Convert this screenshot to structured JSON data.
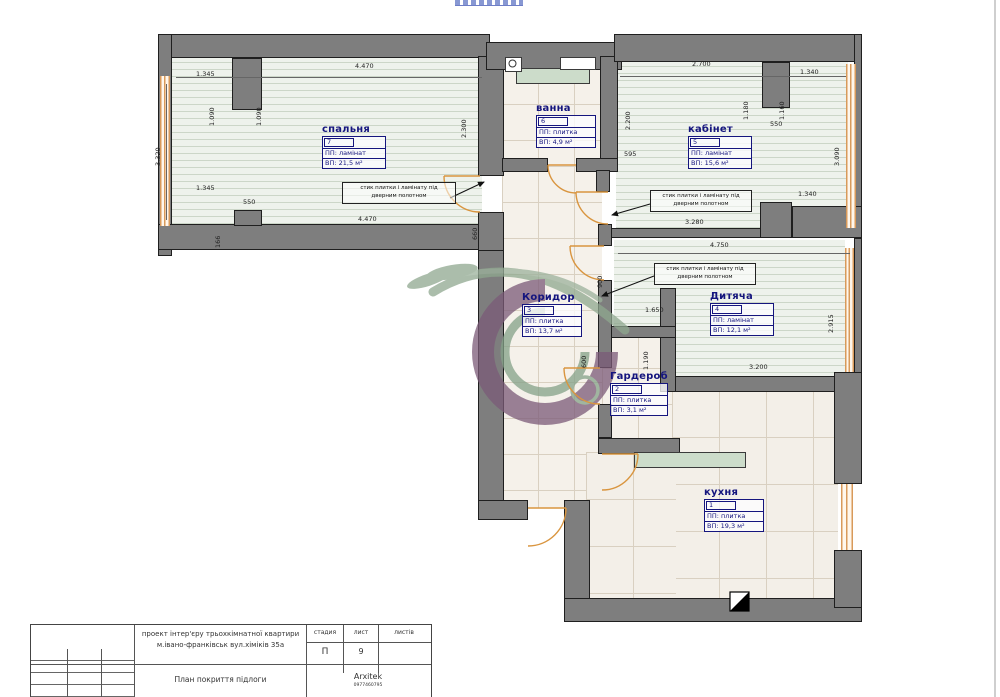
{
  "colors": {
    "wall": "#7e7e7e",
    "wall_outline": "#1f1f1f",
    "door": "#d9953f",
    "window": "#d89a5a",
    "room_label": "#15157e",
    "laminate_bg": "#eef2ec",
    "tile_bg": "#f5f1ea",
    "counter": "#ccdcca",
    "watermark_purple": "#7b5a78",
    "watermark_green": "#8fa88f"
  },
  "rooms": [
    {
      "key": "kukhnia",
      "name": "кухня",
      "num": "1",
      "covering": "ПП: плитка",
      "area": "ВП: 19,3 м²"
    },
    {
      "key": "harderob",
      "name": "Гардероб",
      "num": "2",
      "covering": "ПП: плитка",
      "area": "ВП: 3,1 м²"
    },
    {
      "key": "koridor",
      "name": "Коридор",
      "num": "3",
      "covering": "ПП: плитка",
      "area": "ВП: 13,7 м²"
    },
    {
      "key": "dytiacha",
      "name": "Дитяча",
      "num": "4",
      "covering": "ПП: ламінат",
      "area": "ВП: 12,1 м²"
    },
    {
      "key": "kabinet",
      "name": "кабінет",
      "num": "5",
      "covering": "ПП: ламінат",
      "area": "ВП: 15,6 м²"
    },
    {
      "key": "vanna",
      "name": "ванна",
      "num": "6",
      "covering": "ПП: плитка",
      "area": "ВП: 4,9 м²"
    },
    {
      "key": "spalnya",
      "name": "спальня",
      "num": "7",
      "covering": "ПП: ламінат",
      "area": "ВП: 21,5 м²"
    }
  ],
  "notes": {
    "joint": {
      "line1": "стик плитки і ламінату під",
      "line2": "дверним полотном"
    }
  },
  "dims": [
    {
      "t": "1.345"
    },
    {
      "t": "4.470"
    },
    {
      "t": "1.090"
    },
    {
      "t": "1.090"
    },
    {
      "t": "3.320"
    },
    {
      "t": "2.300"
    },
    {
      "t": "550"
    },
    {
      "t": "1.345"
    },
    {
      "t": "4.470"
    },
    {
      "t": "166"
    },
    {
      "t": "660"
    },
    {
      "t": "2.700"
    },
    {
      "t": "2.200"
    },
    {
      "t": "1.340"
    },
    {
      "t": "1.180"
    },
    {
      "t": "1.160"
    },
    {
      "t": "550"
    },
    {
      "t": "3.090"
    },
    {
      "t": "1.340"
    },
    {
      "t": "3.280"
    },
    {
      "t": "595"
    },
    {
      "t": "4.750"
    },
    {
      "t": "900"
    },
    {
      "t": "1.650"
    },
    {
      "t": "1.190"
    },
    {
      "t": "3.200"
    },
    {
      "t": "2.915"
    },
    {
      "t": "600"
    }
  ],
  "title_block": {
    "project_line1": "проект інтер'єру трьохкімнатної квартири",
    "project_line2": "м.івано-франківськ вул.хіміків 35а",
    "doc_title": "План покриття підлоги",
    "col_stage": "стадия",
    "col_sheet": "лист",
    "col_sheets": "листів",
    "stage": "П",
    "sheet": "9",
    "sheets": "",
    "firm": "Arxitek",
    "firm_phone": "0977460795"
  }
}
